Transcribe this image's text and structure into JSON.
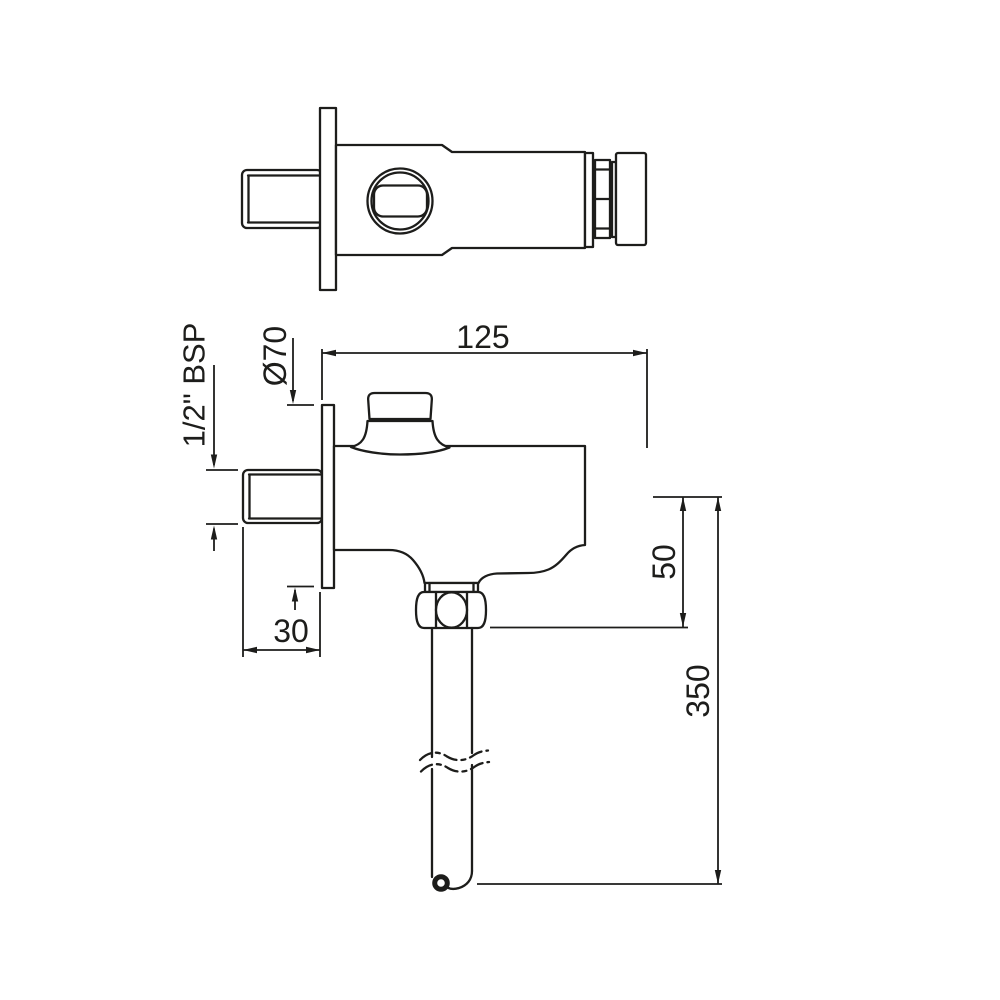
{
  "drawing": {
    "background_color": "#ffffff",
    "line_color": "#1d1d1b",
    "dimensions": {
      "overall_length": "125",
      "flange_diameter": "Ø70",
      "inlet_thread": "1/2\" BSP",
      "inlet_projection": "30",
      "outlet_offset": "50",
      "tailpipe_length": "350"
    }
  }
}
